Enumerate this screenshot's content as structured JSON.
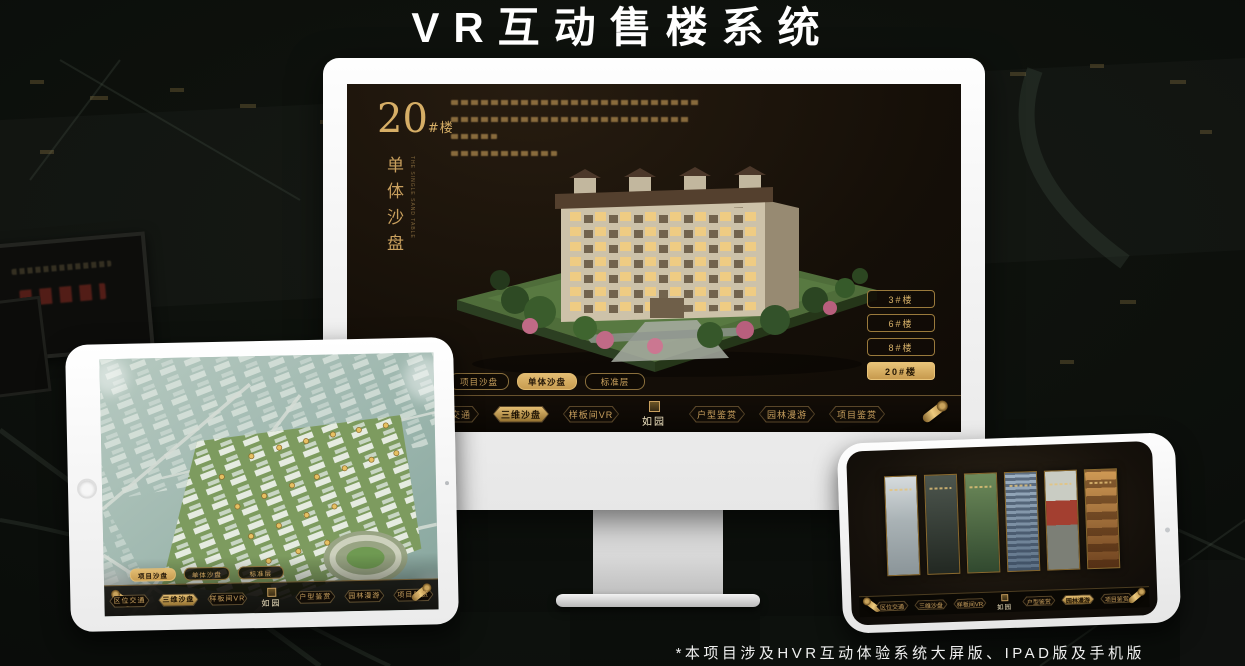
{
  "page": {
    "title": "VR互动售楼系统",
    "footnote": "*本项目涉及HVR互动体验系统大屏版、IPAD版及手机版"
  },
  "colors": {
    "gold_accent": "#c9a05e",
    "gold_active": "#e3bd72",
    "screen_dark": "#150f08",
    "device_white": "#f4f4f4"
  },
  "logo": {
    "text": "如园"
  },
  "monitor": {
    "hero": {
      "number": "20",
      "number_suffix": "#楼",
      "subtitle": "单体沙盘",
      "subtitle_en": "THE SINGLE SAND TABLE"
    },
    "floor_buttons": [
      {
        "label": "3#楼",
        "active": false
      },
      {
        "label": "6#楼",
        "active": false
      },
      {
        "label": "8#楼",
        "active": false
      },
      {
        "label": "20#楼",
        "active": true
      }
    ],
    "sub_tabs": [
      {
        "label": "项目沙盘",
        "active": false
      },
      {
        "label": "单体沙盘",
        "active": true
      },
      {
        "label": "标准层",
        "active": false
      }
    ],
    "nav_left": [
      {
        "label": "区位交通",
        "active": false
      },
      {
        "label": "三维沙盘",
        "active": true
      },
      {
        "label": "样板间VR",
        "active": false
      }
    ],
    "nav_right": [
      {
        "label": "户型鉴赏",
        "active": false
      },
      {
        "label": "园林漫游",
        "active": false
      },
      {
        "label": "项目鉴赏",
        "active": false
      }
    ]
  },
  "tablet": {
    "sub_tabs": [
      {
        "label": "项目沙盘",
        "active": true
      },
      {
        "label": "单体沙盘",
        "active": false
      },
      {
        "label": "标准层",
        "active": false
      }
    ],
    "nav_left": [
      {
        "label": "区位交通",
        "active": false
      },
      {
        "label": "三维沙盘",
        "active": true
      },
      {
        "label": "样板间VR",
        "active": false
      }
    ],
    "nav_right": [
      {
        "label": "户型鉴赏",
        "active": false
      },
      {
        "label": "园林漫游",
        "active": false
      },
      {
        "label": "项目鉴赏",
        "active": false
      }
    ]
  },
  "phone": {
    "nav_left": [
      {
        "label": "区位交通",
        "active": false
      },
      {
        "label": "三维沙盘",
        "active": false
      },
      {
        "label": "样板间VR",
        "active": false
      }
    ],
    "nav_right": [
      {
        "label": "户型鉴赏",
        "active": false
      },
      {
        "label": "园林漫游",
        "active": true
      },
      {
        "label": "项目鉴赏",
        "active": false
      }
    ],
    "gallery_panels": [
      {
        "name": "scene-courtyard"
      },
      {
        "name": "scene-pavilion"
      },
      {
        "name": "scene-garden"
      },
      {
        "name": "scene-building"
      },
      {
        "name": "scene-gate"
      },
      {
        "name": "scene-interior"
      }
    ]
  }
}
